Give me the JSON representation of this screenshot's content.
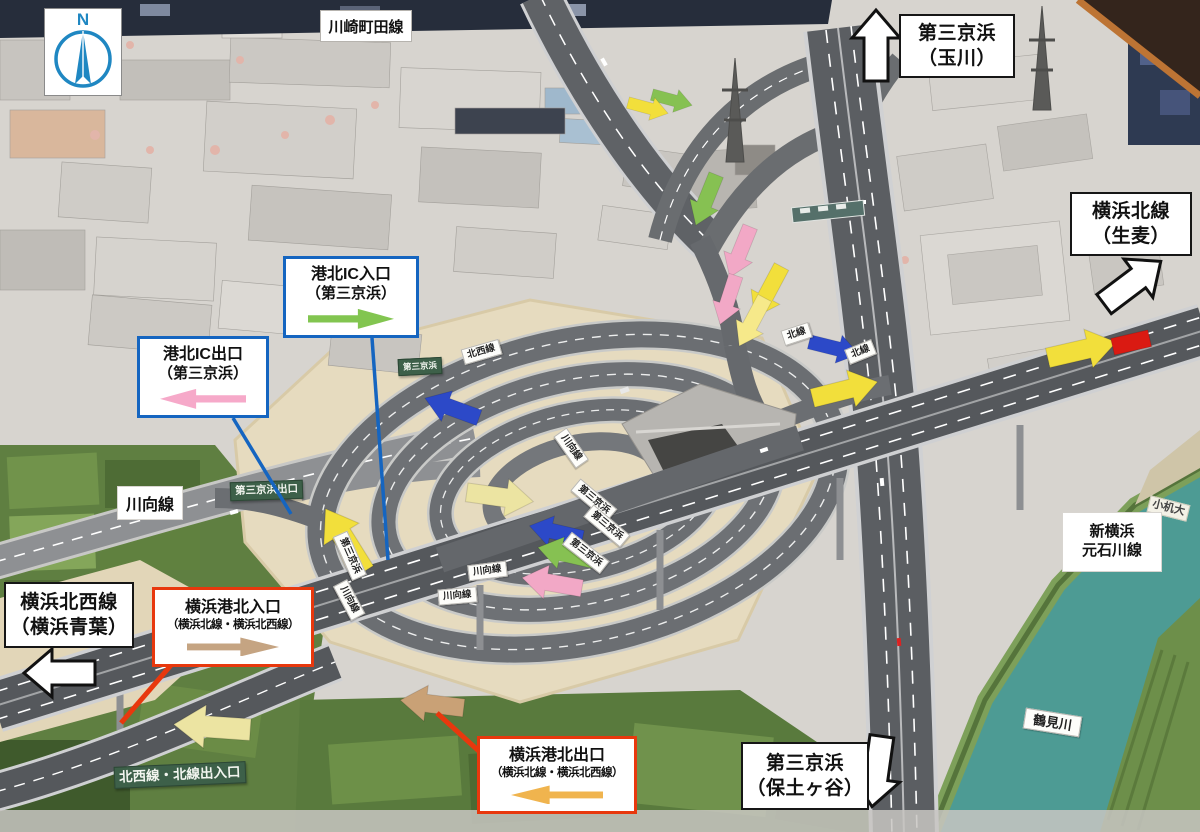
{
  "annotations": {
    "compass": {
      "label": "N"
    },
    "kawasaki_machida_line": {
      "text": "川崎町田線"
    },
    "daisan_keihin_tamagawa": {
      "line1": "第三京浜",
      "line2": "（玉川）"
    },
    "yokohama_kita_line_namamugi": {
      "line1": "横浜北線",
      "line2": "（生麦）"
    },
    "yokohama_hokusei_line_aoba": {
      "line1": "横浜北西線",
      "line2": "（横浜青葉）"
    },
    "daisan_keihin_hodogaya": {
      "line1": "第三京浜",
      "line2": "（保土ヶ谷）"
    },
    "kohoku_ic_entrance": {
      "line1": "港北IC入口",
      "line2": "（第三京浜）",
      "border_color": "#1565c0",
      "arrow_color": "#82c550"
    },
    "kohoku_ic_exit": {
      "line1": "港北IC出口",
      "line2": "（第三京浜）",
      "border_color": "#1565c0",
      "arrow_color": "#f6a9c9"
    },
    "yokohama_kohoku_entrance": {
      "line1": "横浜港北入口",
      "line2": "（横浜北線・横浜北西線）",
      "border_color": "#e8380d",
      "arrow_color": "#c5a482"
    },
    "yokohama_kohoku_exit": {
      "line1": "横浜港北出口",
      "line2": "（横浜北線・横浜北西線）",
      "border_color": "#e8380d",
      "arrow_color": "#f0b44e"
    },
    "shin_yokohama_motoishikawa_line": {
      "line1": "新横浜",
      "line2": "元石川線"
    },
    "kawamuki_line": {
      "text": "川向線"
    }
  },
  "model_labels": {
    "green_signs": [
      {
        "text": "第三京浜出口"
      },
      {
        "text": "北西線・北線出入口"
      },
      {
        "text": "第三京浜"
      }
    ],
    "road_plates": [
      {
        "text": "川向線"
      },
      {
        "text": "川向線"
      },
      {
        "text": "川向線"
      },
      {
        "text": "川向線"
      },
      {
        "text": "第三京浜"
      },
      {
        "text": "第三京浜"
      },
      {
        "text": "第三京浜"
      },
      {
        "text": "第三京浜"
      },
      {
        "text": "北線"
      },
      {
        "text": "北線"
      },
      {
        "text": "北西線"
      }
    ],
    "river_plate": {
      "text": "鶴見川"
    },
    "paper_label": {
      "text": "小机大"
    }
  },
  "marker_colors": {
    "yellow": "#f2df3b",
    "pale_yellow": "#ece4a2",
    "pink": "#f2a8c6",
    "green": "#86c152",
    "blue": "#2c49c8",
    "red": "#da1a12",
    "tan": "#c9a176",
    "orange": "#f0b44e"
  }
}
